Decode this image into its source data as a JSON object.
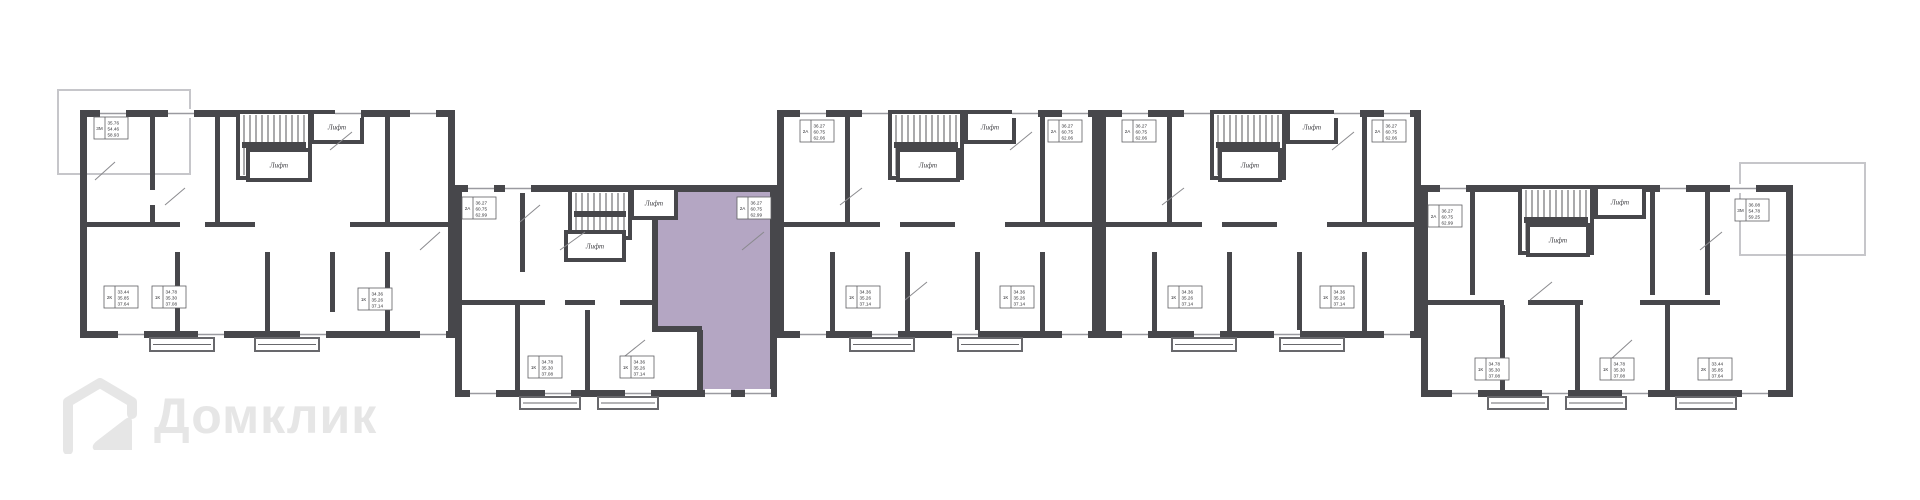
{
  "plan": {
    "lift_label": "Лифт",
    "unit_labels": [
      {
        "type": "3М",
        "a1": "35.76",
        "a2": "54.46",
        "a3": "58.93"
      },
      {
        "type": "2К",
        "a1": "33.44",
        "a2": "35.85",
        "a3": "37.64"
      },
      {
        "type": "1К",
        "a1": "34.78",
        "a2": "35.30",
        "a3": "37.08"
      },
      {
        "type": "1К",
        "a1": "34.36",
        "a2": "35.26",
        "a3": "37.14"
      },
      {
        "type": "2А",
        "a1": "36.27",
        "a2": "60.75",
        "a3": "62.99"
      },
      {
        "type": "2А",
        "a1": "36.27",
        "a2": "60.75",
        "a3": "62.99",
        "highlighted": true
      },
      {
        "type": "1К",
        "a1": "34.78",
        "a2": "35.30",
        "a3": "37.08"
      },
      {
        "type": "1К",
        "a1": "34.36",
        "a2": "35.26",
        "a3": "37.14"
      },
      {
        "type": "2А",
        "a1": "36.27",
        "a2": "60.75",
        "a3": "62.06"
      },
      {
        "type": "2А",
        "a1": "36.27",
        "a2": "60.75",
        "a3": "62.06"
      },
      {
        "type": "1К",
        "a1": "34.36",
        "a2": "35.26",
        "a3": "37.14"
      },
      {
        "type": "1К",
        "a1": "34.36",
        "a2": "35.26",
        "a3": "37.14"
      },
      {
        "type": "2А",
        "a1": "36.27",
        "a2": "60.75",
        "a3": "62.06"
      },
      {
        "type": "2А",
        "a1": "36.27",
        "a2": "60.75",
        "a3": "62.06"
      },
      {
        "type": "1К",
        "a1": "34.36",
        "a2": "35.26",
        "a3": "37.14"
      },
      {
        "type": "1К",
        "a1": "34.36",
        "a2": "35.26",
        "a3": "37.14"
      },
      {
        "type": "2А",
        "a1": "36.27",
        "a2": "60.75",
        "a3": "62.99"
      },
      {
        "type": "3М",
        "a1": "36.08",
        "a2": "54.78",
        "a3": "59.25"
      },
      {
        "type": "1К",
        "a1": "34.78",
        "a2": "35.30",
        "a3": "37.08"
      },
      {
        "type": "1К",
        "a1": "34.78",
        "a2": "35.30",
        "a3": "37.08"
      },
      {
        "type": "2К",
        "a1": "33.44",
        "a2": "35.85",
        "a3": "37.64"
      }
    ]
  },
  "watermark": {
    "brand": "Домклик"
  },
  "colors": {
    "wall": "#47474b",
    "interior_wall": "#47474b",
    "highlight_fill": "#b4a6c3",
    "window_line": "#9a9aa0",
    "terrace_line": "#c6c6ca",
    "balcony_line": "#68686c",
    "stair_line": "#55555a",
    "door_line": "#8a8a8e",
    "label_border": "#5f5f63",
    "label_text": "#2f2f33",
    "logo": "#e6e6e6"
  }
}
